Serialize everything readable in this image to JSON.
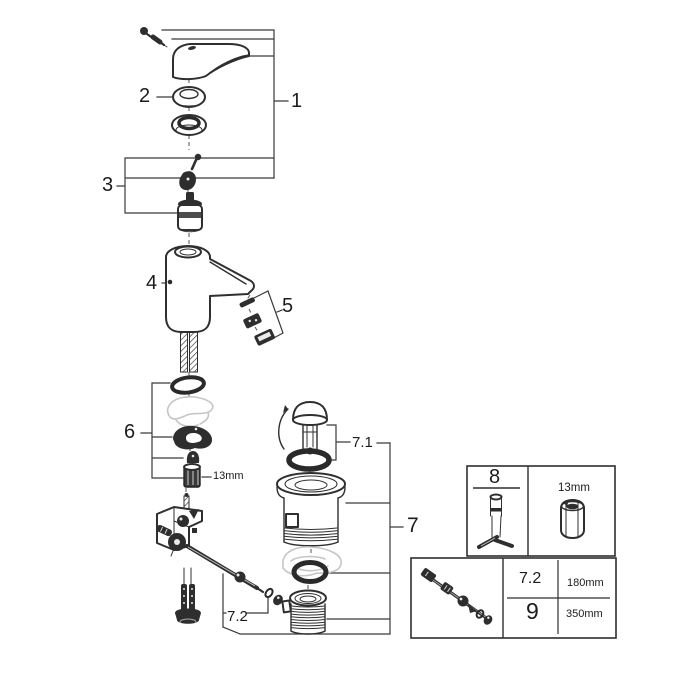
{
  "canvas": {
    "background": "#ffffff",
    "line_color": "#2f2f2f",
    "ghost_part_color": "#c6c6c6",
    "text_color": "#1c1c1c"
  },
  "callouts": {
    "c1": "1",
    "c2": "2",
    "c3": "3",
    "c4": "4",
    "c5": "5",
    "c6": "6",
    "c7": "7",
    "c7_1": "7.1",
    "c7_2": "7.2"
  },
  "annotations": {
    "nut_size": "13mm"
  },
  "info_box_top": {
    "part": "8",
    "tool_size": "13mm"
  },
  "info_box_bottom": {
    "rows": [
      {
        "part": "7.2",
        "length": "180mm"
      },
      {
        "part": "9",
        "length": "350mm"
      }
    ]
  }
}
